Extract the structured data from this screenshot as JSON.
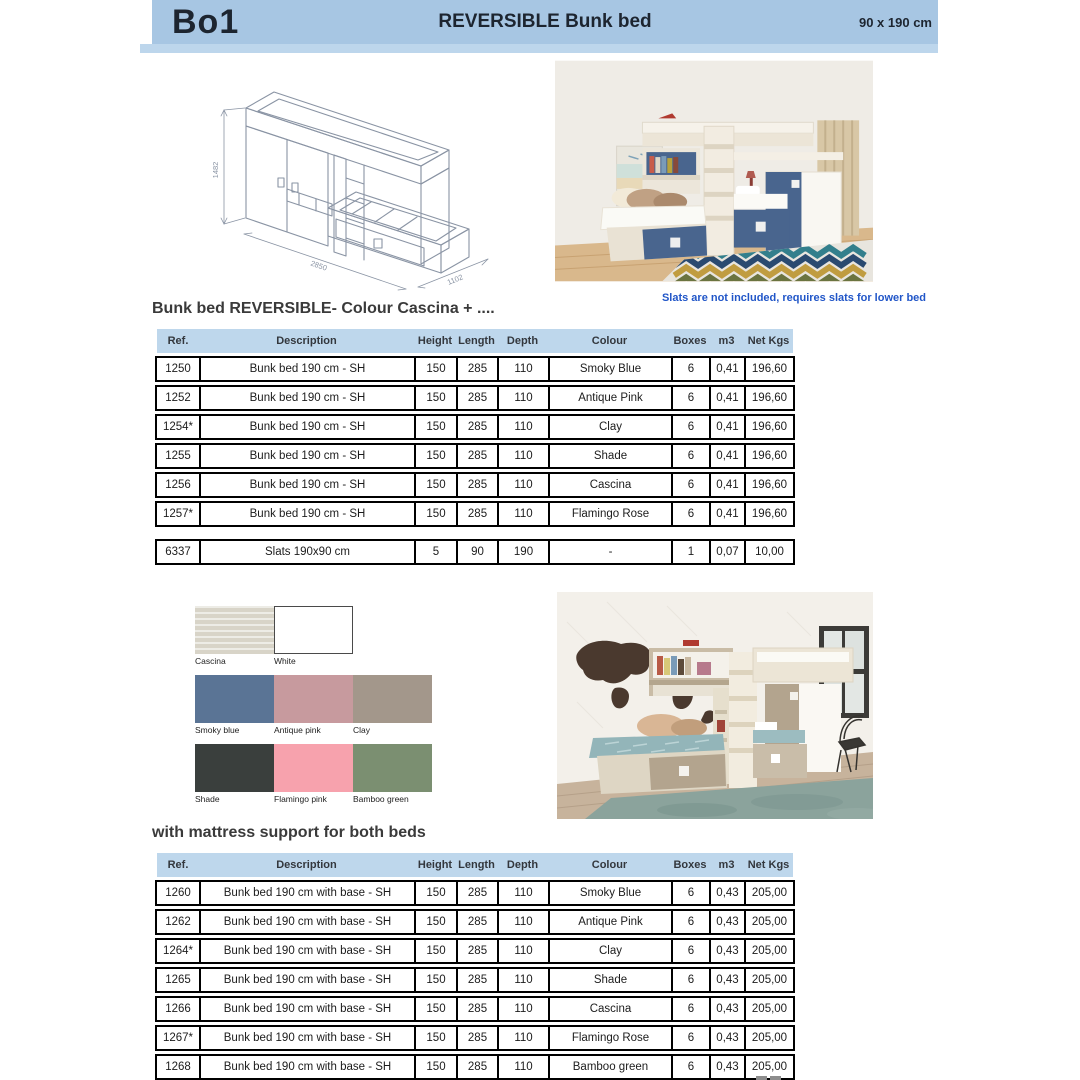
{
  "header": {
    "product_code": "Bo1",
    "title": "REVERSIBLE Bunk bed",
    "size": "90 x 190 cm",
    "bar_color": "#a7c6e3",
    "underline_color": "#bdd6ec",
    "text_color": "#1d2530"
  },
  "drawing": {
    "dim_height": "1482",
    "dim_length": "2850",
    "dim_depth": "1102",
    "line_color": "#8a94a4"
  },
  "note": {
    "text": "Slats are not included, requires slats for lower bed",
    "color": "#2156c8"
  },
  "sections": {
    "first_title": "Bunk bed REVERSIBLE- Colour Cascina + ....",
    "second_title": "with mattress support for both beds"
  },
  "tables": [
    {
      "columns": [
        "Ref.",
        "Description",
        "Height",
        "Length",
        "Depth",
        "Colour",
        "Boxes",
        "m3",
        "Net Kgs"
      ],
      "header_bg": "#bed7ec",
      "rows": [
        [
          "1250",
          "Bunk bed 190 cm - SH",
          "150",
          "285",
          "110",
          "Smoky Blue",
          "6",
          "0,41",
          "196,60"
        ],
        [
          "1252",
          "Bunk bed 190 cm - SH",
          "150",
          "285",
          "110",
          "Antique Pink",
          "6",
          "0,41",
          "196,60"
        ],
        [
          "1254*",
          "Bunk bed 190 cm - SH",
          "150",
          "285",
          "110",
          "Clay",
          "6",
          "0,41",
          "196,60"
        ],
        [
          "1255",
          "Bunk bed 190 cm - SH",
          "150",
          "285",
          "110",
          "Shade",
          "6",
          "0,41",
          "196,60"
        ],
        [
          "1256",
          "Bunk bed 190 cm - SH",
          "150",
          "285",
          "110",
          "Cascina",
          "6",
          "0,41",
          "196,60"
        ],
        [
          "1257*",
          "Bunk bed 190 cm - SH",
          "150",
          "285",
          "110",
          "Flamingo Rose",
          "6",
          "0,41",
          "196,60"
        ],
        "GAP",
        [
          "6337",
          "Slats 190x90 cm",
          "5",
          "90",
          "190",
          "-",
          "1",
          "0,07",
          "10,00"
        ]
      ]
    },
    {
      "columns": [
        "Ref.",
        "Description",
        "Height",
        "Length",
        "Depth",
        "Colour",
        "Boxes",
        "m3",
        "Net Kgs"
      ],
      "header_bg": "#bed7ec",
      "rows": [
        [
          "1260",
          "Bunk bed 190 cm with base - SH",
          "150",
          "285",
          "110",
          "Smoky Blue",
          "6",
          "0,43",
          "205,00"
        ],
        [
          "1262",
          "Bunk bed 190 cm with base - SH",
          "150",
          "285",
          "110",
          "Antique Pink",
          "6",
          "0,43",
          "205,00"
        ],
        [
          "1264*",
          "Bunk bed 190 cm with base - SH",
          "150",
          "285",
          "110",
          "Clay",
          "6",
          "0,43",
          "205,00"
        ],
        [
          "1265",
          "Bunk bed 190 cm with base - SH",
          "150",
          "285",
          "110",
          "Shade",
          "6",
          "0,43",
          "205,00"
        ],
        [
          "1266",
          "Bunk bed 190 cm with base - SH",
          "150",
          "285",
          "110",
          "Cascina",
          "6",
          "0,43",
          "205,00"
        ],
        [
          "1267*",
          "Bunk bed 190 cm with base - SH",
          "150",
          "285",
          "110",
          "Flamingo Rose",
          "6",
          "0,43",
          "205,00"
        ],
        [
          "1268",
          "Bunk bed 190 cm with base - SH",
          "150",
          "285",
          "110",
          "Bamboo green",
          "6",
          "0,43",
          "205,00"
        ]
      ]
    }
  ],
  "swatches": {
    "rows": [
      [
        {
          "label": "Cascina",
          "color": "#d8d4c8",
          "textured": true
        },
        {
          "label": "White",
          "color": "#ffffff",
          "bordered": true
        }
      ],
      [
        {
          "label": "Smoky blue",
          "color": "#5a7495"
        },
        {
          "label": "Antique pink",
          "color": "#c79a9e"
        },
        {
          "label": "Clay",
          "color": "#a3978b"
        }
      ],
      [
        {
          "label": "Shade",
          "color": "#3a3f3d"
        },
        {
          "label": "Flamingo pink",
          "color": "#f7a2ad"
        },
        {
          "label": "Bamboo green",
          "color": "#7b8f71"
        }
      ]
    ]
  }
}
